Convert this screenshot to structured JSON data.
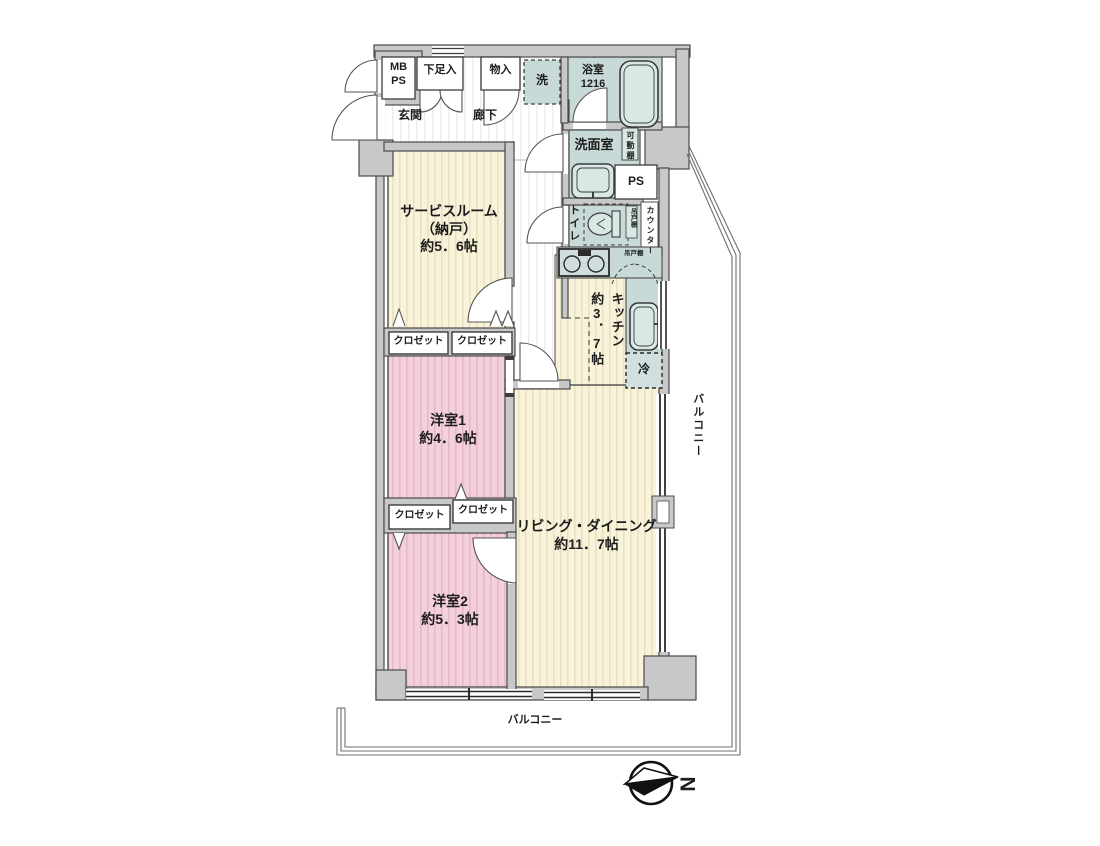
{
  "floorplan": {
    "mb_ps": {
      "line1": "MB",
      "line2": "PS"
    },
    "shoe_cabinet": "下足入",
    "storage": "物入",
    "washer": "洗",
    "bath": {
      "name": "浴室",
      "size": "1216"
    },
    "entrance": "玄関",
    "corridor": "廊下",
    "washroom": "洗面室",
    "movable_shelf": "可動棚",
    "pipe_space": "PS",
    "toilet": "トイレ",
    "hanging_cupboard_toilet": "吊戸棚",
    "counter": "カウンター",
    "hanging_cupboard_kitchen": "吊戸棚",
    "kitchen": {
      "name": "キッチン",
      "size": "約3．7帖"
    },
    "fridge": "冷",
    "service_room": {
      "name": "サービスルーム",
      "sub": "（納戸）",
      "size": "約5．6帖"
    },
    "closets": [
      "クロゼット",
      "クロゼット",
      "クロゼット",
      "クロゼット"
    ],
    "bedroom1": {
      "name": "洋室1",
      "size": "約4．6帖"
    },
    "bedroom2": {
      "name": "洋室2",
      "size": "約5．3帖"
    },
    "living": {
      "name": "リビング・ダイニング",
      "size": "約11．7帖"
    },
    "balcony_right": "バルコニー",
    "balcony_bottom": "バルコニー",
    "compass_north": "N",
    "colors": {
      "wall": "#c8c8c8",
      "cream": "#f9f3da",
      "pink": "#f4cfdc",
      "teal": "#c7dad8"
    }
  }
}
